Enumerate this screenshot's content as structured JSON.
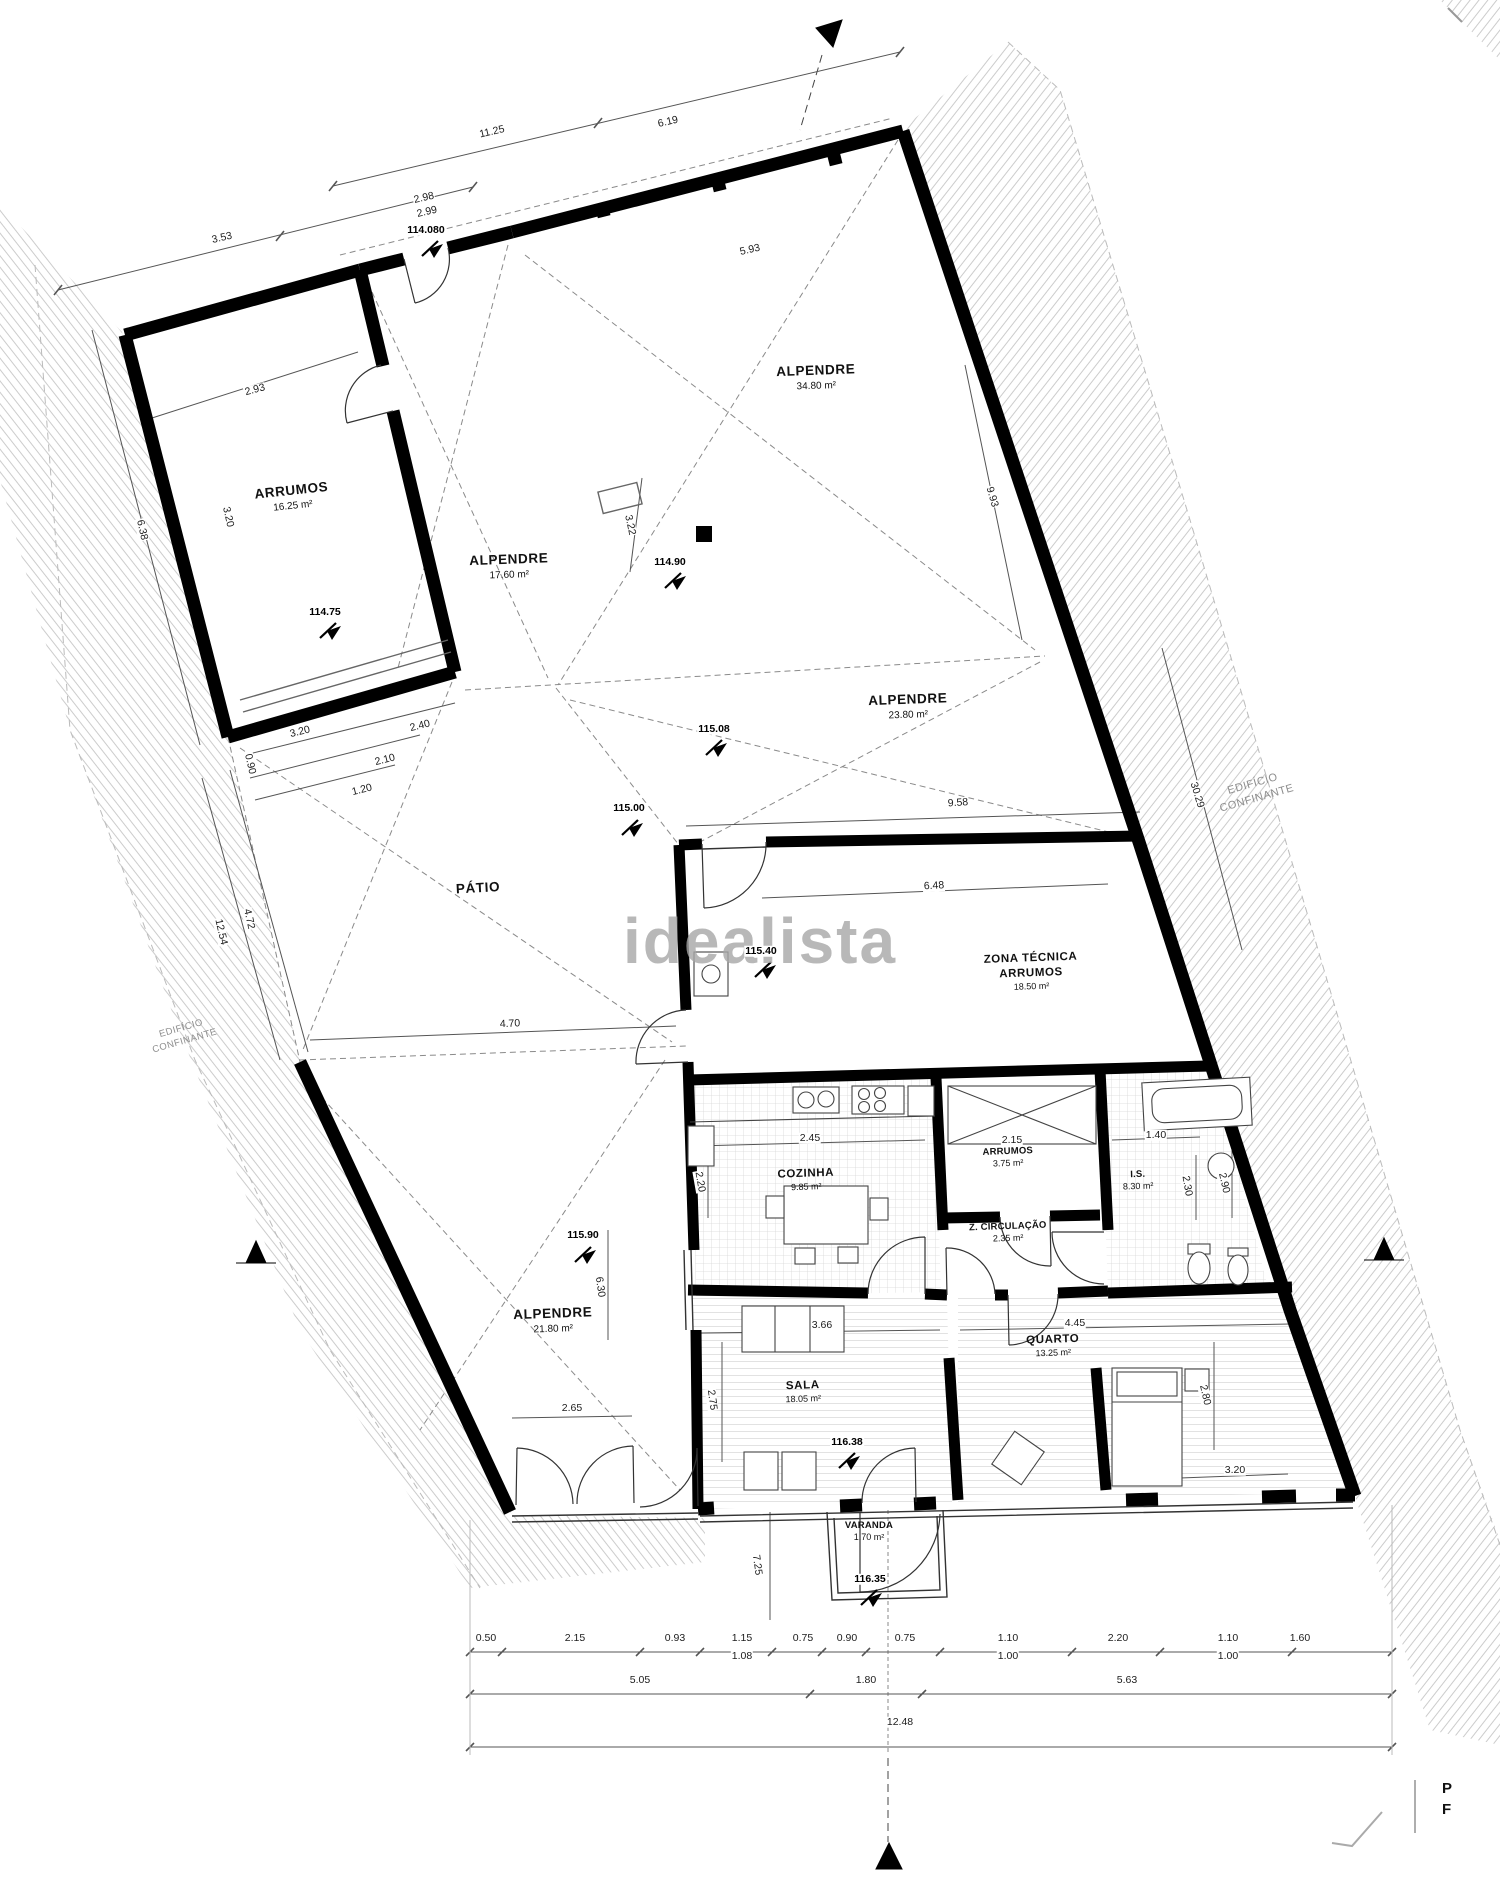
{
  "plan": {
    "watermark": "idealista",
    "adjacent_right": {
      "line1": "EDIFÍCIO",
      "line2": "CONFINANTE"
    },
    "adjacent_left": {
      "line1": "EDIFÍCIO",
      "line2": "CONFINANTE"
    },
    "corner_letters": {
      "l1": "P",
      "l2": "F"
    },
    "rooms": [
      {
        "name": "ARRUMOS",
        "area": "16.25 m²"
      },
      {
        "name": "ALPENDRE",
        "area": "17.60 m²"
      },
      {
        "name": "ALPENDRE",
        "area": "34.80 m²"
      },
      {
        "name": "ALPENDRE",
        "area": "23.80 m²"
      },
      {
        "name": "PÁTIO",
        "area": ""
      },
      {
        "name": "ZONA TÉCNICA",
        "name2": "ARRUMOS",
        "area": "18.50 m²"
      },
      {
        "name": "COZINHA",
        "area": "9.85 m²"
      },
      {
        "name": "ARRUMOS",
        "area": "3.75 m²"
      },
      {
        "name": "I.S.",
        "area": "8.30 m²"
      },
      {
        "name": "Z. CIRCULAÇÃO",
        "area": "2.35 m²"
      },
      {
        "name": "ALPENDRE",
        "area": "21.80 m²"
      },
      {
        "name": "SALA",
        "area": "18.05 m²"
      },
      {
        "name": "QUARTO",
        "area": "13.25 m²"
      },
      {
        "name": "VARANDA",
        "area": "1.70 m²"
      }
    ],
    "elevations": [
      "114.080",
      "114.75",
      "114.90",
      "115.08",
      "115.00",
      "115.40",
      "115.90",
      "116.38",
      "116.35"
    ],
    "dims": [
      "11.25",
      "6.19",
      "2.98",
      "2.99",
      "3.53",
      "5.93",
      "2.93",
      "3.20",
      "6.38",
      "9.93",
      "3.22",
      "9.58",
      "30.29",
      "6.48",
      "3.20",
      "2.40",
      "2.10",
      "1.20",
      "0.90",
      "12.54",
      "4.72",
      "4.70",
      "2.45",
      "2.20",
      "2.15",
      "1.40",
      "2.30",
      "2.90",
      "3.66",
      "4.45",
      "2.75",
      "2.65",
      "2.80",
      "3.20",
      "6.30",
      "7.25",
      "0.50",
      "2.15",
      "0.93",
      "1.15",
      "0.75",
      "0.90",
      "0.75",
      "1.10",
      "2.20",
      "1.10",
      "1.60",
      "1.08",
      "1.00",
      "1.00",
      "5.05",
      "1.80",
      "5.63",
      "12.48"
    ]
  }
}
